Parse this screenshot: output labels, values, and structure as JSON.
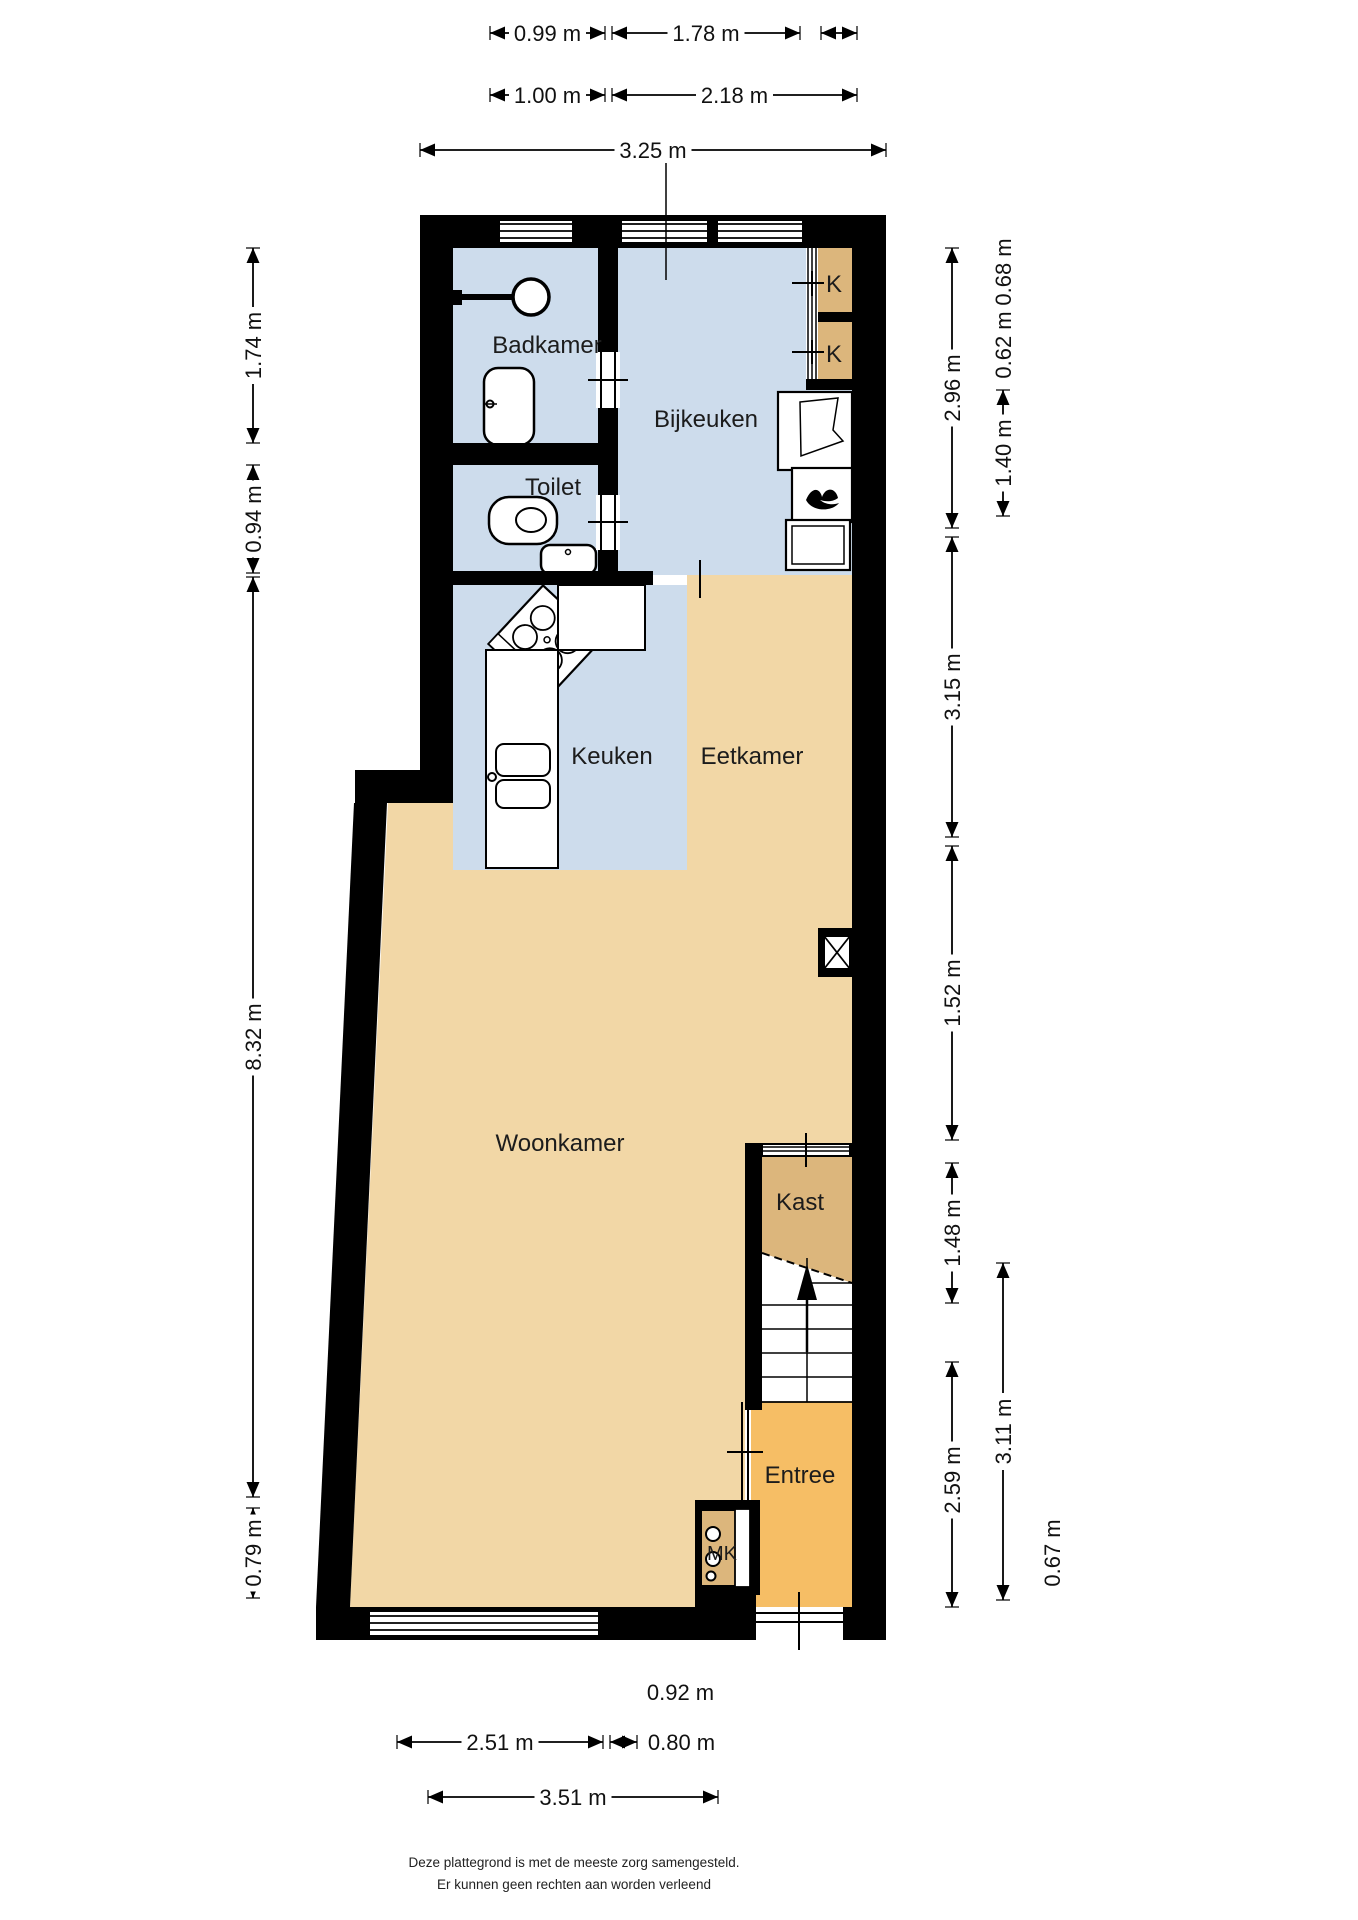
{
  "colors": {
    "wall": "#000000",
    "wet_room_blue": "#cddcec",
    "living_beige": "#f2d7a6",
    "closet_tan": "#dcb67c",
    "entry_orange": "#f6be65"
  },
  "rooms": {
    "badkamer": {
      "label": "Badkamer"
    },
    "toilet": {
      "label": "Toilet"
    },
    "bijkeuken": {
      "label": "Bijkeuken"
    },
    "keuken": {
      "label": "Keuken"
    },
    "eetkamer": {
      "label": "Eetkamer"
    },
    "woonkamer": {
      "label": "Woonkamer"
    },
    "kast": {
      "label": "Kast"
    },
    "entree": {
      "label": "Entree"
    },
    "meterkast": {
      "label": "MK"
    },
    "closet_top": {
      "label": "K"
    },
    "closet_bottom": {
      "label": "K"
    }
  },
  "dimensions": [
    {
      "id": "top-a",
      "orient": "h",
      "axis": 33,
      "from": 490,
      "to": 605,
      "label": "0.99 m"
    },
    {
      "id": "top-b",
      "orient": "h",
      "axis": 33,
      "from": 612,
      "to": 800,
      "label": "1.78 m"
    },
    {
      "id": "top-c",
      "orient": "h",
      "axis": 33,
      "from": 821,
      "to": 857,
      "label": ""
    },
    {
      "id": "top-d",
      "orient": "h",
      "axis": 95,
      "from": 490,
      "to": 605,
      "label": "1.00 m"
    },
    {
      "id": "top-e",
      "orient": "h",
      "axis": 95,
      "from": 612,
      "to": 857,
      "label": "2.18 m"
    },
    {
      "id": "top-f",
      "orient": "h",
      "axis": 150,
      "from": 420,
      "to": 886,
      "label": "3.25 m"
    },
    {
      "id": "left-a",
      "orient": "v",
      "axis": 253,
      "from": 248,
      "to": 443,
      "label": "1.74 m"
    },
    {
      "id": "left-b",
      "orient": "v",
      "axis": 253,
      "from": 465,
      "to": 573,
      "label": "0.94 m"
    },
    {
      "id": "left-c",
      "orient": "v",
      "axis": 253,
      "from": 577,
      "to": 1497,
      "label": "8.32 m"
    },
    {
      "id": "left-d",
      "orient": "v",
      "axis": 253,
      "from": 1508,
      "to": 1598,
      "label": "0.79 m"
    },
    {
      "id": "right-a",
      "orient": "v",
      "axis": 952,
      "from": 248,
      "to": 528,
      "label": "2.96 m"
    },
    {
      "id": "right-b",
      "orient": "v",
      "axis": 952,
      "from": 537,
      "to": 837,
      "label": "3.15 m"
    },
    {
      "id": "right-c",
      "orient": "v",
      "axis": 952,
      "from": 846,
      "to": 1140,
      "label": "1.52 m",
      "label_at": 993
    },
    {
      "id": "right-d",
      "orient": "v",
      "axis": 952,
      "from": 1163,
      "to": 1303,
      "label": "1.48 m"
    },
    {
      "id": "right-e",
      "orient": "v",
      "axis": 952,
      "from": 1362,
      "to": 1607,
      "label": "2.59 m",
      "label_at": 1480
    },
    {
      "id": "right-f",
      "orient": "v",
      "axis": 1003,
      "from": 272,
      "to": 272,
      "label": "0.68 m"
    },
    {
      "id": "right-g",
      "orient": "v",
      "axis": 1003,
      "from": 345,
      "to": 345,
      "label": "0.62 m"
    },
    {
      "id": "right-h",
      "orient": "v",
      "axis": 1003,
      "from": 390,
      "to": 516,
      "label": "1.40 m"
    },
    {
      "id": "right-i",
      "orient": "v",
      "axis": 1003,
      "from": 1263,
      "to": 1600,
      "label": "3.11 m"
    },
    {
      "id": "right-j",
      "orient": "v",
      "axis": 1052,
      "from": 1553,
      "to": 1553,
      "label": "0.67 m"
    },
    {
      "id": "bottom-a",
      "orient": "h",
      "axis": 1692,
      "from": 643,
      "to": 718,
      "label": "0.92 m"
    },
    {
      "id": "bottom-b",
      "orient": "h",
      "axis": 1742,
      "from": 397,
      "to": 603,
      "label": "2.51 m"
    },
    {
      "id": "bottom-c",
      "orient": "h",
      "axis": 1742,
      "from": 610,
      "to": 637,
      "label": ""
    },
    {
      "id": "bottom-d",
      "orient": "h",
      "axis": 1742,
      "from": 645,
      "to": 718,
      "label": "0.80 m"
    },
    {
      "id": "bottom-e",
      "orient": "h",
      "axis": 1797,
      "from": 428,
      "to": 718,
      "label": "3.51 m"
    }
  ],
  "footer": {
    "line1": "Deze plattegrond is met de meeste zorg samengesteld.",
    "line2": "Er kunnen geen rechten aan worden verleend"
  }
}
